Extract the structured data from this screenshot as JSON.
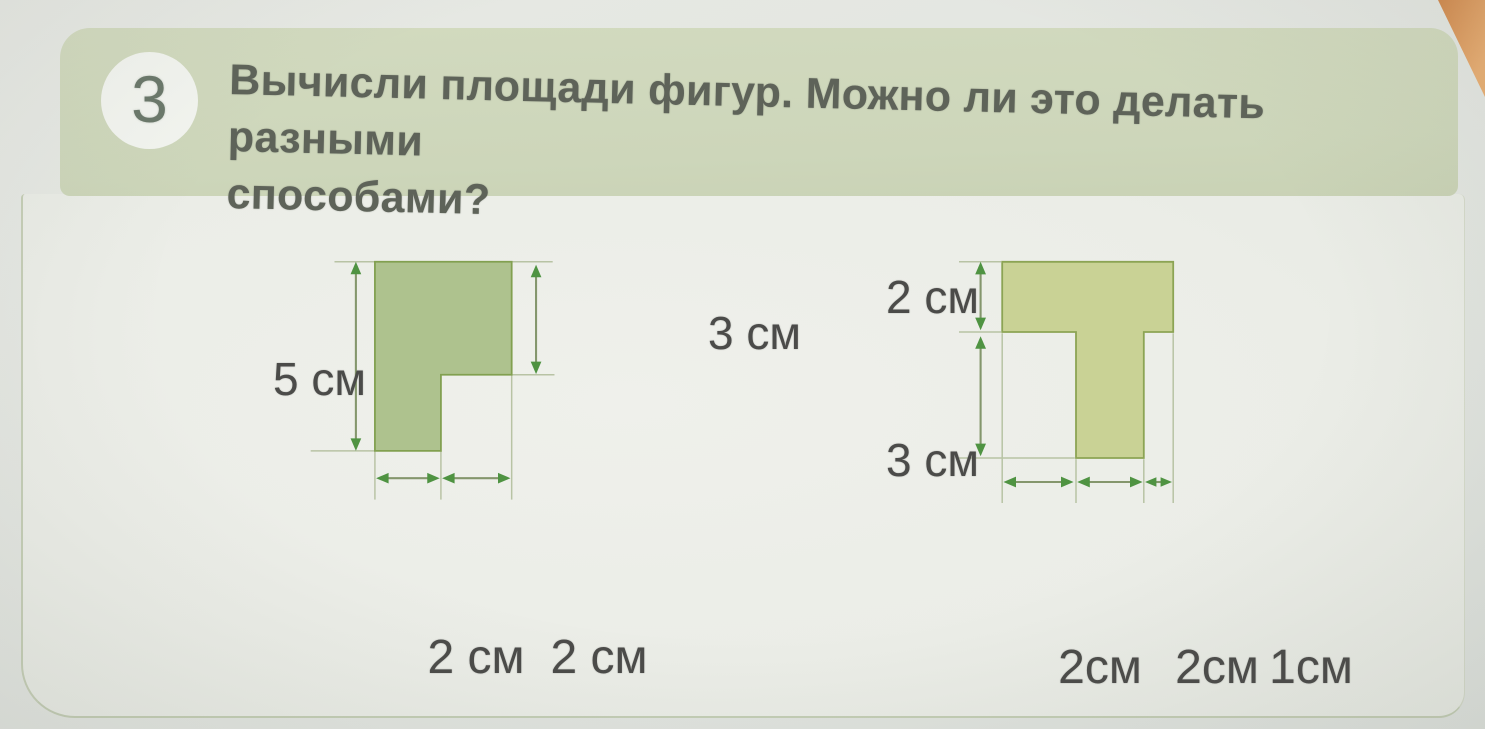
{
  "task": {
    "number": "3",
    "title_line1": "Вычисли площади фигур. Можно ли это делать разными",
    "title_line2": "способами?"
  },
  "figure_left": {
    "shape": "L-shape",
    "fill": "#aec28e",
    "stroke": "#82a050",
    "dimensions_cm": {
      "height": 5,
      "right_height": 3,
      "bottom_widths": [
        2,
        2
      ]
    },
    "labels": {
      "height": "5 см",
      "right_height": "3 см",
      "bottom": [
        "2 см",
        "2 см"
      ]
    }
  },
  "figure_right": {
    "shape": "T-shape",
    "fill": "#c9d295",
    "stroke": "#8ca454",
    "dimensions_cm": {
      "top_height": 2,
      "stem_height": 3,
      "bottom_widths": [
        2,
        2,
        1
      ]
    },
    "labels": {
      "top_height": "2 см",
      "stem_height": "3 см",
      "bottom": [
        "2см",
        "2см",
        "1см"
      ]
    }
  },
  "colors": {
    "page_background": "#e3e6e1",
    "card_background": "#edeee9",
    "header_band": "#cfd8bc",
    "badge_background": "#f2f4ef",
    "title_text": "#5e6359",
    "label_text": "#4b4b49",
    "guide_line": "#b8c3a4",
    "arrow_shaft": "#84966c",
    "arrow_head": "#4f9342",
    "book_corner_orange": "#d08a4f"
  }
}
